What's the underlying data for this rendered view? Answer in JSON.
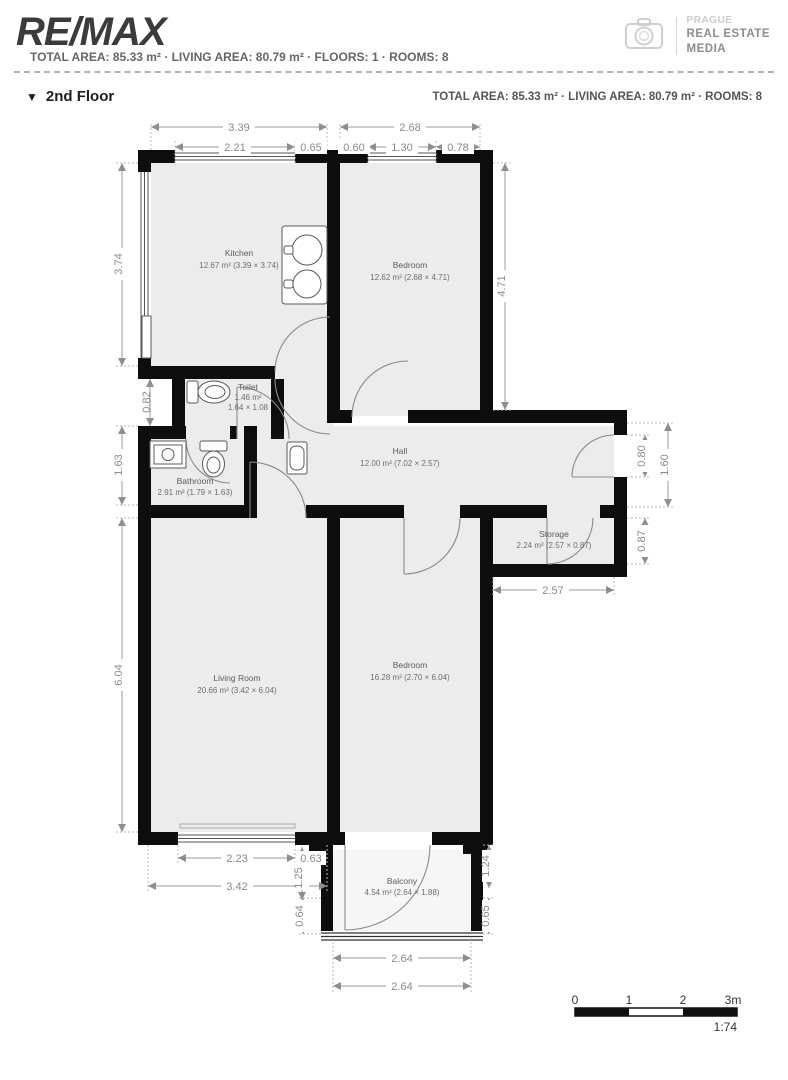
{
  "header": {
    "brand": "RE/MAX",
    "stats": "TOTAL AREA: 85.33 m² · LIVING AREA: 80.79 m² · FLOORS: 1 · ROOMS: 8",
    "media": {
      "l1": "PRAGUE",
      "l2": "REAL ESTATE",
      "l3": "MEDIA"
    }
  },
  "floor": {
    "title": "2nd Floor",
    "marker": "▼",
    "stats": "TOTAL AREA: 85.33 m² · LIVING AREA: 80.79 m² · ROOMS: 8"
  },
  "rooms": {
    "kitchen": {
      "name": "Kitchen",
      "details": "12.67 m² (3.39 × 3.74)"
    },
    "bedroom_top": {
      "name": "Bedroom",
      "details": "12.62 m² (2.68 × 4.71)"
    },
    "toilet": {
      "name": "Toilet",
      "area": "1.46 m²",
      "size": "1.64 × 1.08"
    },
    "bathroom": {
      "name": "Bathroom",
      "details": "2.91 m² (1.79 × 1.63)"
    },
    "hall": {
      "name": "Hall",
      "details": "12.00 m² (7.02 × 2.57)"
    },
    "storage": {
      "name": "Storage",
      "details": "2.24 m² (2.57 × 0.87)"
    },
    "living": {
      "name": "Living Room",
      "details": "20.66 m² (3.42 × 6.04)"
    },
    "bedroom_bottom": {
      "name": "Bedroom",
      "details": "16.28 m² (2.70 × 6.04)"
    },
    "balcony": {
      "name": "Balcony",
      "details": "4.54 m² (2.64 × 1.88)"
    }
  },
  "dims": {
    "top_339": "3.39",
    "top_268": "2.68",
    "top_221": "2.21",
    "top_065": "0.65",
    "top_060": "0.60",
    "top_130": "1.30",
    "top_078": "0.78",
    "left_374": "3.74",
    "left_082": "0.82",
    "left_163": "1.63",
    "left_604": "6.04",
    "right_471": "4.71",
    "right_080": "0.80",
    "right_160": "1.60",
    "right_087": "0.87",
    "right_257": "2.57",
    "bot_223": "2.23",
    "bot_063": "0.63",
    "bot_342": "3.42",
    "bot_125": "1.25",
    "bal_064": "0.64",
    "bal_065": "0.65",
    "bal_124": "1.24",
    "bal_264a": "2.64",
    "bal_264b": "2.64"
  },
  "scale": {
    "t0": "0",
    "t1": "1",
    "t2": "2",
    "t3": "3m",
    "ratio": "1:74"
  }
}
